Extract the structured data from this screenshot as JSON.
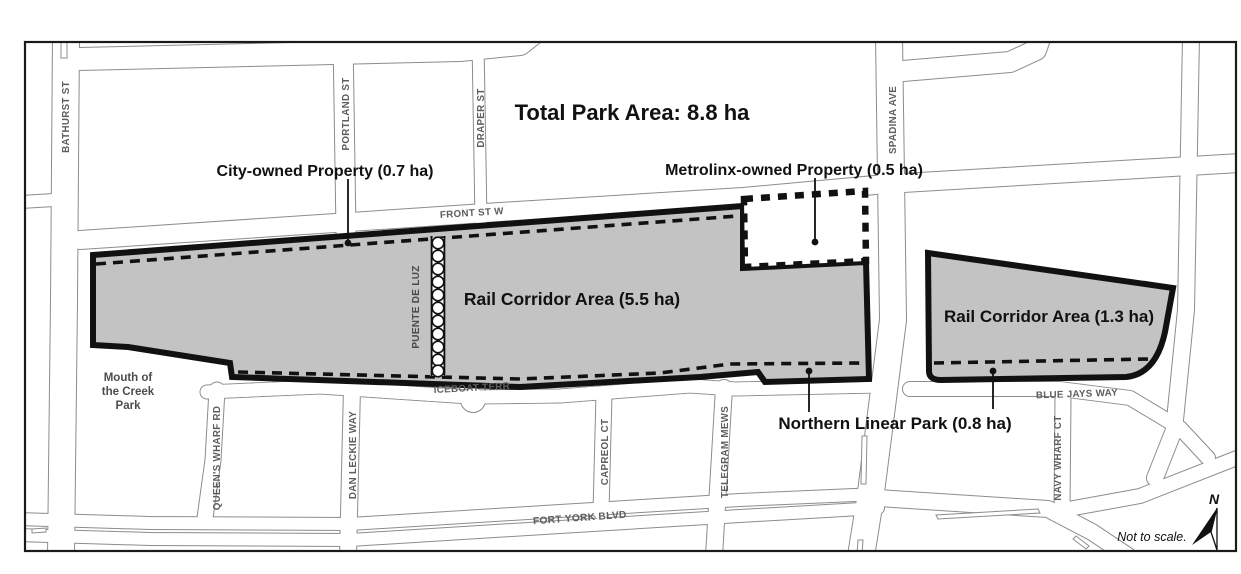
{
  "figure": {
    "title": "Total Park Area: 8.8 ha",
    "annotations": {
      "city_owned": "City-owned Property (0.7 ha)",
      "metrolinx_owned": "Metrolinx-owned Property (0.5 ha)",
      "rail_corridor_west": "Rail Corridor Area (5.5 ha)",
      "rail_corridor_east": "Rail Corridor Area (1.3 ha)",
      "northern_linear_park": "Northern Linear Park (0.8 ha)",
      "mouth_of_the_creek_park": [
        "Mouth of",
        "the Creek",
        "Park"
      ],
      "bridge": "PUENTE DE LUZ"
    },
    "streets": {
      "bathurst": "BATHURST ST",
      "portland": "PORTLAND ST",
      "draper": "DRAPER ST",
      "spadina": "SPADINA AVE",
      "front": "FRONT ST W",
      "iceboat": "ICEBOAT TERR",
      "queens_wharf": "QUEEN'S WHARF RD",
      "dan_leckie": "DAN LECKIE WAY",
      "capreol": "CAPREOL CT",
      "telegram": "TELEGRAM MEWS",
      "navy_wharf": "NAVY WHARF CT",
      "blue_jays": "BLUE JAYS WAY",
      "fort_york": "FORT YORK BLVD"
    },
    "compass": {
      "north": "N",
      "scale_note": "Not to scale."
    },
    "colors": {
      "parcel_fill": "#c3c3c3",
      "boundary": "#111111",
      "street_casing": "#8c8c8c",
      "street_label": "#5e5e5e"
    }
  }
}
